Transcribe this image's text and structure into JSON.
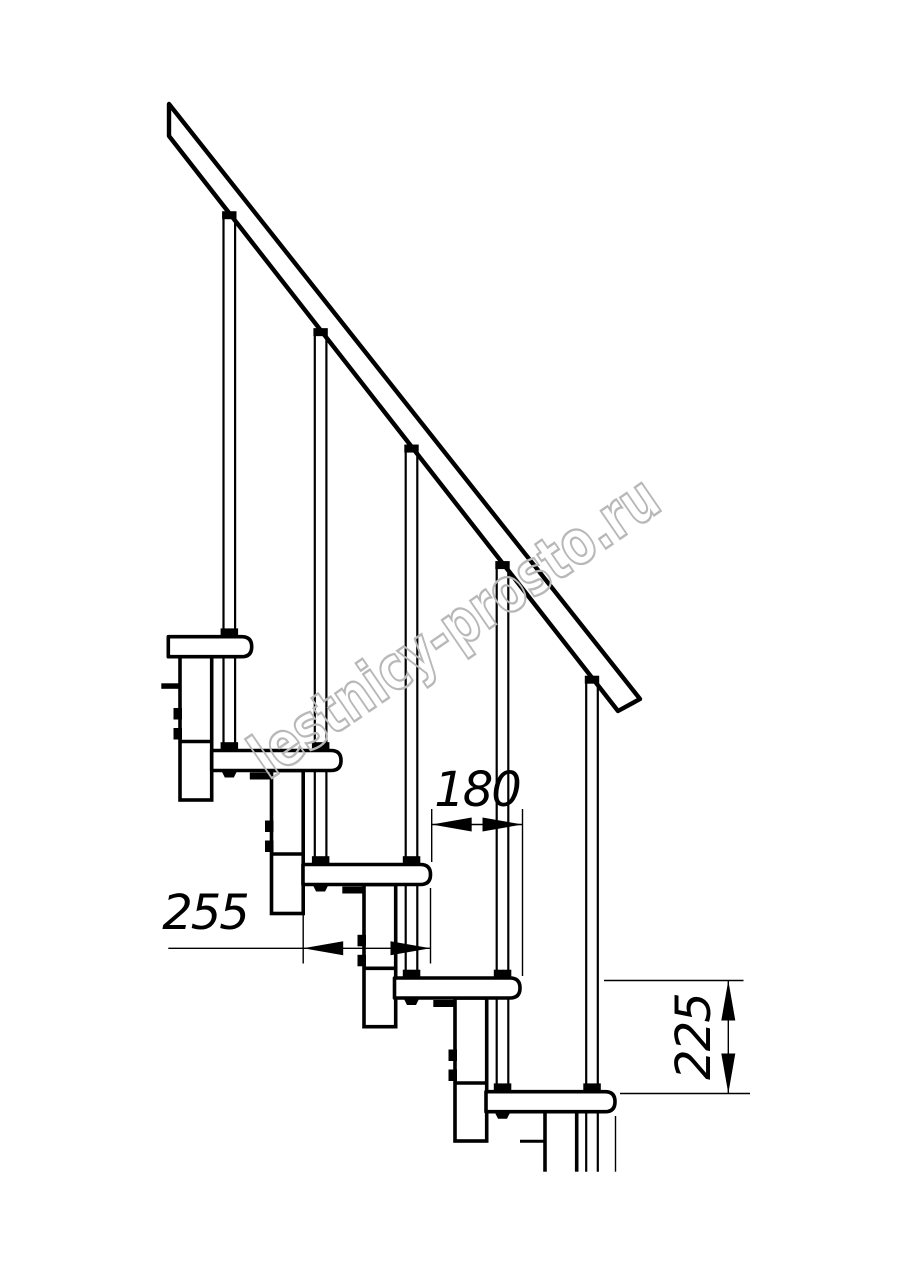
{
  "watermark": {
    "text": "lestnicy-prosto.ru",
    "color": "#b8b8b8"
  },
  "dimensions": [
    {
      "id": "tread-depth",
      "label": "255"
    },
    {
      "id": "step-run",
      "label": "180"
    },
    {
      "id": "step-rise",
      "label": "225"
    }
  ],
  "drawing": {
    "line_color": "#000000",
    "background": "#ffffff",
    "rail": {
      "upper": [
        169,
        104,
        640,
        699
      ],
      "lower": [
        169,
        136,
        618,
        711
      ],
      "stroke": 4.4
    },
    "step_thickness": 20,
    "step_radius": 10,
    "steps": [
      {
        "left": 168.3,
        "top": 636.7,
        "right": 251.7
      },
      {
        "left": 211.7,
        "top": 750.5,
        "right": 341
      },
      {
        "left": 303,
        "top": 864.5,
        "right": 430.5
      },
      {
        "left": 394.5,
        "top": 978,
        "right": 520
      },
      {
        "left": 486,
        "top": 1091.7,
        "right": 615
      }
    ],
    "baluster_cx": [
      229.3,
      320.6,
      411.5,
      502.5,
      592
    ],
    "baluster_half_gap": 5.8,
    "baluster_cut_bottom": 1171.7,
    "columns": [
      {
        "left": 180,
        "top": 656.7,
        "joint": 741.5,
        "bottom": 800
      },
      {
        "left": 271.5,
        "top": 770.5,
        "joint": 854,
        "bottom": 913.5
      },
      {
        "left": 364,
        "top": 884.5,
        "joint": 968.3,
        "bottom": 1026.7
      },
      {
        "left": 455,
        "top": 998,
        "joint": 1083,
        "bottom": 1141
      },
      {
        "left": 545,
        "top": 1111.7,
        "joint": null,
        "bottom": 1171.7,
        "open": true
      }
    ],
    "column_width": 31.7,
    "plates": [
      {
        "x": 161.3,
        "y": 683.3,
        "w": 18.7,
        "h": 5.5
      },
      {
        "x": 249.8,
        "y": 772.5,
        "w": 21.7,
        "h": 7
      },
      {
        "x": 342.3,
        "y": 886.5,
        "w": 21.7,
        "h": 7
      },
      {
        "x": 433.3,
        "y": 1000,
        "w": 21.7,
        "h": 7
      }
    ],
    "extra_lines": [
      {
        "x1": 520,
        "y1": 1141.3,
        "x2": 545,
        "y2": 1141.3,
        "w": 3
      },
      {
        "x1": 615.5,
        "y1": 1116,
        "x2": 615.5,
        "y2": 1171.7,
        "w": 1.4
      }
    ],
    "dims": [
      {
        "ext": [
          [
            303.2,
            911,
            303.2,
            963.5
          ],
          [
            430.5,
            888,
            430.5,
            963.5
          ]
        ],
        "line": [
          168.3,
          948.3,
          430.5,
          948.3
        ],
        "arrows": [
          {
            "x": 303.2,
            "y": 948.3,
            "dir": "left"
          },
          {
            "x": 430.5,
            "y": 948.3,
            "dir": "right"
          }
        ]
      },
      {
        "ext": [
          [
            431.7,
            809,
            431.7,
            862
          ],
          [
            522.5,
            809,
            522.5,
            976
          ]
        ],
        "line": [
          431.7,
          824.5,
          522.5,
          824.5
        ],
        "arrows": [
          {
            "x": 431.7,
            "y": 824.5,
            "dir": "left"
          },
          {
            "x": 522.5,
            "y": 824.5,
            "dir": "right"
          }
        ]
      },
      {
        "ext": [
          [
            604,
            980.5,
            743.5,
            980.5
          ],
          [
            620,
            1093.5,
            750,
            1093.5
          ]
        ],
        "line": [
          728.3,
          980.5,
          728.3,
          1093.5
        ],
        "arrows": [
          {
            "x": 728.3,
            "y": 980.5,
            "dir": "up"
          },
          {
            "x": 728.3,
            "y": 1093.5,
            "dir": "down"
          }
        ]
      }
    ],
    "arrow": {
      "length": 40,
      "half_width": 7
    },
    "thin_stroke": 1.4,
    "main_stroke": 3.6,
    "baluster_stroke": 2.2
  }
}
